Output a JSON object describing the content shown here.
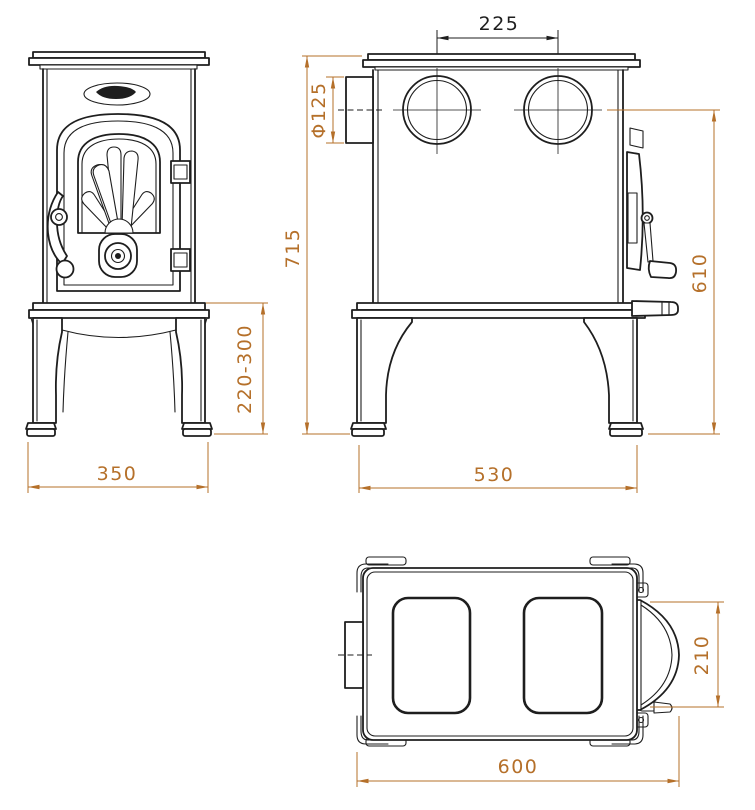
{
  "figure": {
    "colors": {
      "line": "#1e1e1e",
      "dimension": "#b5702a",
      "background": "#ffffff"
    },
    "views": {
      "front": {
        "dims": {
          "width": "350",
          "leg_height": "220-300"
        }
      },
      "side": {
        "dims": {
          "flue_spacing": "225",
          "flue_diameter": "Φ125",
          "overall_height": "715",
          "flue_center_height": "610",
          "depth": "530"
        }
      },
      "top": {
        "dims": {
          "overall_depth": "600",
          "door_width": "210"
        }
      }
    }
  }
}
